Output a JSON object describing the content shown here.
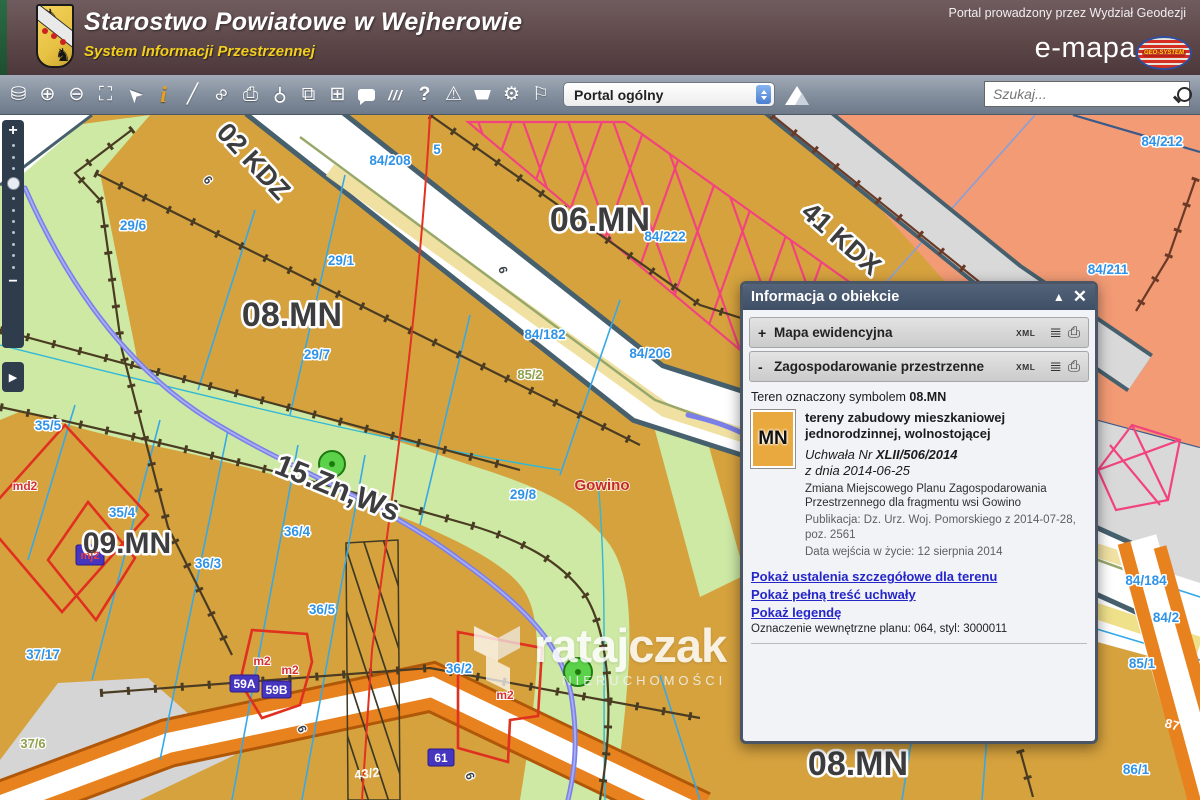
{
  "header": {
    "org_title": "Starostwo Powiatowe w Wejherowie",
    "org_subtitle": "System Informacji Przestrzennej",
    "portal_note": "Portal prowadzony przez Wydział Geodezji",
    "brand": "e-mapa",
    "brand_logo_text": "GEO-SYSTEM"
  },
  "toolbar": {
    "portal_select": "Portal ogólny",
    "search_placeholder": "Szukaj...",
    "icons": [
      {
        "name": "layers-icon",
        "glyph": "⛁"
      },
      {
        "name": "zoom-in-icon",
        "glyph": "⊕"
      },
      {
        "name": "zoom-out-icon",
        "glyph": "⊖"
      },
      {
        "name": "select-area-icon",
        "glyph": "⛶"
      },
      {
        "name": "pointer-icon",
        "glyph": "➤"
      },
      {
        "name": "info-icon",
        "glyph": "i"
      },
      {
        "name": "measure-icon",
        "glyph": "╱"
      },
      {
        "name": "link-icon",
        "glyph": "∞"
      },
      {
        "name": "print-icon",
        "glyph": "⎙"
      },
      {
        "name": "pushpin-icon",
        "glyph": "⚲"
      },
      {
        "name": "copy-view-icon",
        "glyph": "⧉"
      },
      {
        "name": "layout-icon",
        "glyph": "⊞"
      },
      {
        "name": "comment-icon",
        "glyph": ""
      },
      {
        "name": "hatch-icon",
        "glyph": "///"
      },
      {
        "name": "help-icon",
        "glyph": "?"
      },
      {
        "name": "alerts-icon",
        "glyph": "⚠"
      },
      {
        "name": "cart-icon",
        "glyph": ""
      },
      {
        "name": "settings-icon",
        "glyph": "⚙"
      },
      {
        "name": "locate-icon",
        "glyph": "⚐"
      }
    ]
  },
  "map_controls": {
    "zoom_in": "+",
    "zoom_out": "−",
    "panel_toggle": "▶"
  },
  "popup": {
    "title": "Informacja o obiekcie",
    "collapse_icon": "▲",
    "close_icon": "✕",
    "xml_label": "XML",
    "sections": [
      {
        "prefix": "+",
        "label": "Mapa ewidencyjna"
      },
      {
        "prefix": "-",
        "label": "Zagospodarowanie przestrzenne"
      }
    ],
    "teren_prefix": "Teren oznaczony symbolem",
    "teren_symbol": "08.MN",
    "swatch_label": "MN",
    "land_use_title": "tereny zabudowy mieszkaniowej jednorodzinnej, wolnostojącej",
    "uchwala_prefix": "Uchwała Nr",
    "uchwala_nr": "XLII/506/2014",
    "uchwala_date": "z dnia 2014-06-25",
    "plan_desc": "Zmiana Miejscowego Planu Zagospodarowania Przestrzennego dla fragmentu wsi Gowino",
    "publication": "Publikacja: Dz. Urz. Woj. Pomorskiego z 2014-07-28, poz. 2561",
    "effective_date": "Data wejścia w życie: 12 sierpnia 2014",
    "links": [
      "Pokaż ustalenia szczegółowe dla terenu",
      "Pokaż pełną treść uchwały",
      "Pokaż legendę"
    ],
    "internal_note": "Oznaczenie wewnętrzne planu: 064, styl: 3000011"
  },
  "map": {
    "watermark": {
      "brand": "ratajczak",
      "tagline": "NIERUCHOMOŚCI"
    },
    "labels": {
      "z08a": "08.MN",
      "z06": "06.MN",
      "z09": "09.MN",
      "z08b": "08.MN",
      "kdz": "02 KDZ",
      "kdx": "41 KDX",
      "zn15": "15.Zn,Ws",
      "p29_6": "29/6",
      "p29_1": "29/1",
      "p29_7": "29/7",
      "p29_8": "29/8",
      "p84_208": "84/208",
      "p84_222": "84/222",
      "p84_182": "84/182",
      "p84_206": "84/206",
      "p84_212": "84/212",
      "p84_211": "84/211",
      "p84_184": "84/184",
      "p84_2": "84/2",
      "p85_1": "85/1",
      "p86_1": "86/1",
      "p35_5": "35/5",
      "p35_4": "35/4",
      "p36_4": "36/4",
      "p36_3": "36/3",
      "p36_5": "36/5",
      "p37_17": "37/17",
      "p36_2": "36/2",
      "p85_2": "85/2",
      "p37_6": "37/6",
      "n5a": "5",
      "n5b": "5",
      "n6a": "6",
      "n6b": "6",
      "n6c": "6",
      "n6d": "6",
      "p43_2": "43/2",
      "p87": "87",
      "md2": "md2",
      "m2a": "m2",
      "m2b": "m2",
      "m2c": "m2",
      "gowino": "Gowino",
      "b59a": "59A",
      "b59b": "59B",
      "b61": "61",
      "mj2": "mj2"
    }
  }
}
